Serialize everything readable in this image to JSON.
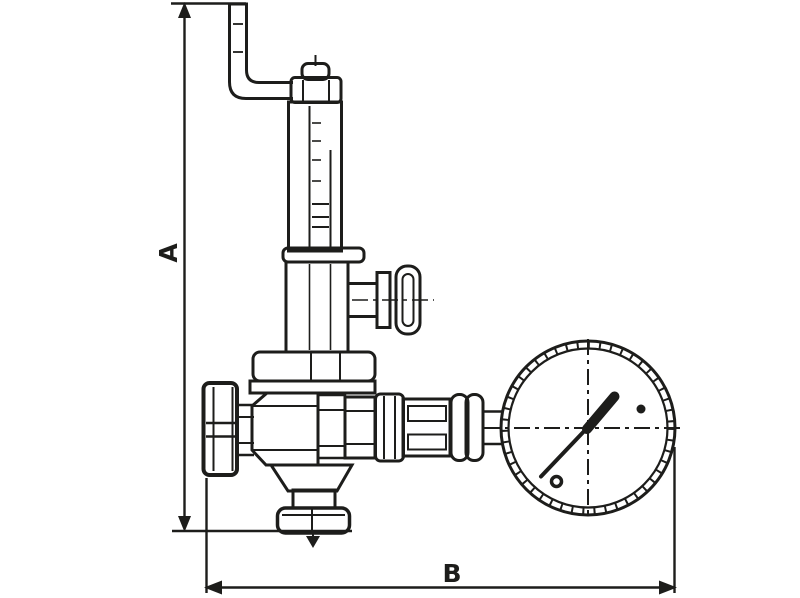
{
  "page": {
    "background": "#ffffff"
  },
  "drawing": {
    "type": "technical-line-drawing",
    "subject": "adjustable pressure relief valve with inlet pipe and pressure gauge",
    "line_color": "#1d1d1b",
    "labels": {
      "dim_vertical": "A",
      "dim_horizontal": "B"
    }
  }
}
